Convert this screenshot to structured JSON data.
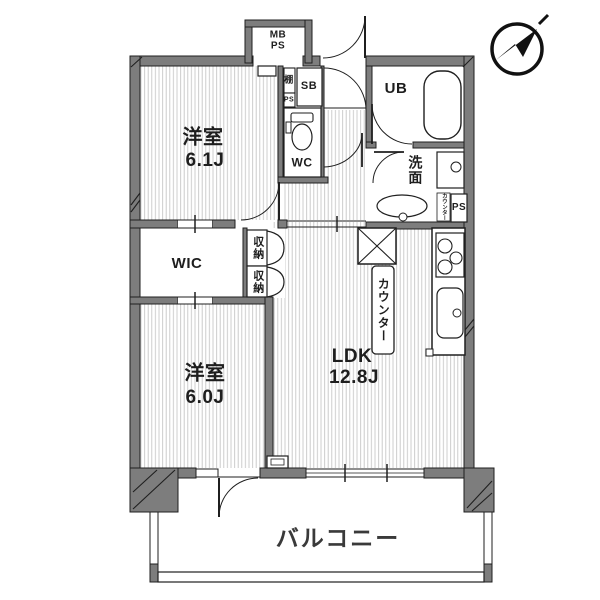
{
  "colors": {
    "wall_fill": "#7d7d7d",
    "outline": "#1f1f1f",
    "floor_stripe": "#c7c7c7",
    "text": "#1e1e1e"
  },
  "labels": {
    "bedroom1_name": "洋室",
    "bedroom1_size": "6.1J",
    "bedroom2_name": "洋室",
    "bedroom2_size": "6.0J",
    "ldk_name": "LDK",
    "ldk_size": "12.8J",
    "wic": "WIC",
    "wc": "WC",
    "ub": "UB",
    "washroom": "洗面",
    "balcony": "バルコニー",
    "meter_box": "MB\nPS",
    "shoe_box": "SB",
    "shelf": "棚",
    "ps_small": "PS",
    "ps": "PS",
    "storage_upper": "収納",
    "storage_lower": "収納",
    "counter": "カウンター",
    "counter_small": "カウンター"
  },
  "compass": {
    "direction": "NE"
  }
}
